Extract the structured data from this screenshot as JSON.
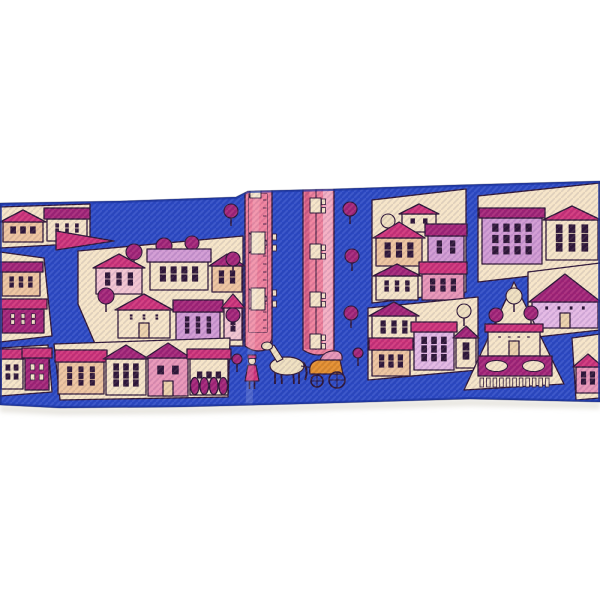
{
  "palette": {
    "white": "#ffffff",
    "blue": "#2c49c4",
    "blueDark": "#1d34a0",
    "outline": "#2e1536",
    "cream": "#f5e3c6",
    "creamDark": "#ecd0a9",
    "peach": "#edc39d",
    "palePink": "#f2c3cf",
    "pink": "#e793b5",
    "lilac": "#d098d2",
    "lilacLight": "#e2b6e2",
    "magenta": "#a32376",
    "rose": "#cd3178",
    "riverPink": "#ee7e9a",
    "riverLight": "#f3adc1",
    "riverDark": "#d75d82",
    "orange": "#e28c2b",
    "horse": "#efdfbe",
    "shadow": "#d9d5cc"
  },
  "scarf": {
    "band": {
      "top": [
        [
          0,
          203
        ],
        [
          120,
          201
        ],
        [
          236,
          197
        ],
        [
          248,
          191
        ],
        [
          332,
          189
        ],
        [
          455,
          185
        ],
        [
          600,
          181
        ]
      ],
      "bottom": [
        [
          0,
          405
        ],
        [
          60,
          408
        ],
        [
          180,
          407
        ],
        [
          300,
          404
        ],
        [
          470,
          399
        ],
        [
          600,
          402
        ]
      ]
    }
  },
  "scene": {
    "blocks": [
      {
        "name": "city-block-top-left",
        "ground": {
          "points": [
            [
              0,
              207
            ],
            [
              90,
              204
            ],
            [
              90,
              243
            ],
            [
              0,
              248
            ]
          ],
          "fill": "cream"
        },
        "items": [
          {
            "type": "house",
            "x": 3,
            "y": 242,
            "w": 40,
            "wallH": 20,
            "roofH": 12,
            "wall": "peach",
            "roof": "rose",
            "style": "gable",
            "win": [
              1,
              3
            ]
          },
          {
            "type": "house",
            "x": 47,
            "y": 241,
            "w": 40,
            "wallH": 22,
            "roofH": 11,
            "wall": "cream",
            "roof": "magenta",
            "style": "flat",
            "win": [
              2,
              3
            ]
          }
        ]
      },
      {
        "name": "street-spire",
        "items": [
          {
            "type": "spire",
            "pts": [
              [
                56,
                231
              ],
              [
                114,
                241
              ],
              [
                56,
                250
              ]
            ],
            "fill": "rose"
          }
        ]
      },
      {
        "name": "city-block-left-main",
        "ground": {
          "points": [
            [
              78,
              251
            ],
            [
              243,
              236
            ],
            [
              243,
              346
            ],
            [
              96,
              346
            ],
            [
              78,
              304
            ]
          ],
          "fill": "cream"
        },
        "items": [
          {
            "type": "tree",
            "x": 134,
            "y": 268,
            "r": 8
          },
          {
            "type": "tree",
            "x": 164,
            "y": 262,
            "r": 8
          },
          {
            "type": "tree",
            "x": 192,
            "y": 258,
            "r": 7
          },
          {
            "type": "house",
            "x": 96,
            "y": 294,
            "w": 46,
            "wallH": 26,
            "roofH": 14,
            "wall": "palePink",
            "roof": "rose",
            "style": "gable",
            "win": [
              2,
              3
            ]
          },
          {
            "type": "house",
            "x": 150,
            "y": 290,
            "w": 58,
            "wallH": 28,
            "roofH": 13,
            "wall": "cream",
            "roof": "lilac",
            "style": "flat",
            "win": [
              2,
              4
            ]
          },
          {
            "type": "house",
            "x": 212,
            "y": 292,
            "w": 30,
            "wallH": 26,
            "roofH": 12,
            "wall": "peach",
            "roof": "magenta",
            "style": "gable",
            "win": [
              2,
              2
            ]
          },
          {
            "type": "tree",
            "x": 106,
            "y": 312,
            "r": 8
          },
          {
            "type": "house",
            "x": 118,
            "y": 338,
            "w": 52,
            "wallH": 28,
            "roofH": 16,
            "wall": "cream",
            "roof": "rose",
            "style": "gable",
            "win": [
              2,
              3
            ],
            "door": true
          },
          {
            "type": "house",
            "x": 176,
            "y": 342,
            "w": 44,
            "wallH": 30,
            "roofH": 12,
            "wall": "lilac",
            "roof": "magenta",
            "style": "flat",
            "win": [
              3,
              3
            ]
          },
          {
            "type": "house",
            "x": 224,
            "y": 340,
            "w": 18,
            "wallH": 32,
            "roofH": 14,
            "wall": "palePink",
            "roof": "rose",
            "style": "gable",
            "win": [
              3,
              1
            ]
          }
        ]
      },
      {
        "name": "city-block-left-edge",
        "ground": {
          "points": [
            [
              0,
              252
            ],
            [
              44,
              258
            ],
            [
              52,
              336
            ],
            [
              0,
              342
            ]
          ],
          "fill": "cream"
        },
        "items": [
          {
            "type": "house",
            "x": 2,
            "y": 296,
            "w": 38,
            "wallH": 24,
            "roofH": 10,
            "wall": "peach",
            "roof": "magenta",
            "style": "flat",
            "win": [
              2,
              3
            ]
          },
          {
            "type": "house",
            "x": 2,
            "y": 333,
            "w": 42,
            "wallH": 24,
            "roofH": 10,
            "wall": "magenta",
            "roof": "rose",
            "style": "flat",
            "win": [
              2,
              3
            ],
            "winFill": "cream"
          }
        ]
      },
      {
        "name": "city-block-left-corner",
        "ground": {
          "points": [
            [
              0,
              348
            ],
            [
              48,
              345
            ],
            [
              52,
              392
            ],
            [
              0,
              396
            ]
          ],
          "fill": "cream"
        },
        "items": [
          {
            "type": "house",
            "x": 1,
            "y": 389,
            "w": 22,
            "wallH": 30,
            "roofH": 10,
            "wall": "cream",
            "roof": "rose",
            "style": "flat",
            "win": [
              2,
              2
            ]
          },
          {
            "type": "house",
            "x": 25,
            "y": 390,
            "w": 24,
            "wallH": 32,
            "roofH": 10,
            "wall": "magenta",
            "roof": "rose",
            "style": "flat",
            "win": [
              2,
              2
            ],
            "winFill": "cream"
          }
        ]
      },
      {
        "name": "city-block-bottom-row",
        "ground": {
          "points": [
            [
              54,
              344
            ],
            [
              230,
              338
            ],
            [
              228,
              397
            ],
            [
              60,
              400
            ]
          ],
          "fill": "cream"
        },
        "items": [
          {
            "type": "house",
            "x": 58,
            "y": 394,
            "w": 46,
            "wallH": 32,
            "roofH": 12,
            "wall": "peach",
            "roof": "rose",
            "style": "flat",
            "win": [
              3,
              3
            ]
          },
          {
            "type": "house",
            "x": 106,
            "y": 395,
            "w": 40,
            "wallH": 36,
            "roofH": 14,
            "wall": "cream",
            "roof": "magenta",
            "style": "gable",
            "win": [
              3,
              3
            ]
          },
          {
            "type": "house",
            "x": 148,
            "y": 396,
            "w": 40,
            "wallH": 38,
            "roofH": 15,
            "wall": "pink",
            "roof": "magenta",
            "style": "gable",
            "win": [
              1,
              2
            ],
            "door": true
          },
          {
            "type": "house",
            "x": 190,
            "y": 395,
            "w": 38,
            "wallH": 36,
            "roofH": 10,
            "wall": "cream",
            "roof": "rose",
            "style": "flat",
            "win": [
              1,
              3
            ],
            "cypress": 4
          }
        ]
      },
      {
        "name": "riverside-trees",
        "items": [
          {
            "type": "tree",
            "x": 231,
            "y": 226,
            "r": 7
          },
          {
            "type": "tree",
            "x": 233,
            "y": 274,
            "r": 7
          },
          {
            "type": "tree",
            "x": 233,
            "y": 330,
            "r": 7
          },
          {
            "type": "tree",
            "x": 350,
            "y": 224,
            "r": 7
          },
          {
            "type": "tree",
            "x": 352,
            "y": 271,
            "r": 7
          },
          {
            "type": "tree",
            "x": 351,
            "y": 328,
            "r": 7
          },
          {
            "type": "tree",
            "x": 237,
            "y": 372,
            "r": 5
          },
          {
            "type": "tree",
            "x": 358,
            "y": 366,
            "r": 5
          }
        ]
      },
      {
        "name": "city-block-right-top",
        "ground": {
          "points": [
            [
              372,
              200
            ],
            [
              466,
              189
            ],
            [
              466,
              292
            ],
            [
              372,
              303
            ]
          ],
          "fill": "cream"
        },
        "items": [
          {
            "type": "tree",
            "x": 388,
            "y": 236,
            "r": 7,
            "fill": "horse"
          },
          {
            "type": "house",
            "x": 402,
            "y": 232,
            "w": 34,
            "wallH": 18,
            "roofH": 10,
            "wall": "cream",
            "roof": "rose",
            "style": "gable",
            "win": [
              1,
              2
            ]
          },
          {
            "type": "house",
            "x": 376,
            "y": 266,
            "w": 46,
            "wallH": 28,
            "roofH": 16,
            "wall": "peach",
            "roof": "rose",
            "style": "gable",
            "win": [
              2,
              3
            ]
          },
          {
            "type": "house",
            "x": 428,
            "y": 262,
            "w": 36,
            "wallH": 26,
            "roofH": 12,
            "wall": "lilac",
            "roof": "magenta",
            "style": "flat",
            "win": [
              2,
              2
            ]
          },
          {
            "type": "house",
            "x": 376,
            "y": 300,
            "w": 42,
            "wallH": 24,
            "roofH": 12,
            "wall": "cream",
            "roof": "magenta",
            "style": "gable",
            "win": [
              2,
              3
            ]
          },
          {
            "type": "house",
            "x": 422,
            "y": 300,
            "w": 42,
            "wallH": 26,
            "roofH": 12,
            "wall": "pink",
            "roof": "rose",
            "style": "flat",
            "win": [
              2,
              3
            ]
          }
        ]
      },
      {
        "name": "city-block-top-right-corner",
        "ground": {
          "points": [
            [
              478,
              196
            ],
            [
              600,
              183
            ],
            [
              600,
              268
            ],
            [
              478,
              282
            ]
          ],
          "fill": "cream"
        },
        "items": [
          {
            "type": "house",
            "x": 482,
            "y": 264,
            "w": 60,
            "wallH": 46,
            "roofH": 10,
            "wall": "lilac",
            "roof": "magenta",
            "style": "flat",
            "win": [
              3,
              4
            ]
          },
          {
            "type": "house",
            "x": 546,
            "y": 260,
            "w": 52,
            "wallH": 40,
            "roofH": 14,
            "wall": "cream",
            "roof": "rose",
            "style": "gable",
            "win": [
              3,
              3
            ]
          }
        ]
      },
      {
        "name": "city-block-big-roof",
        "ground": {
          "points": [
            [
              528,
              272
            ],
            [
              600,
              263
            ],
            [
              600,
              330
            ],
            [
              528,
              338
            ]
          ],
          "fill": "cream"
        },
        "items": [
          {
            "type": "house",
            "x": 532,
            "y": 328,
            "w": 66,
            "wallH": 26,
            "roofH": 28,
            "wall": "lilacLight",
            "roof": "magenta",
            "style": "gable",
            "win": [
              1,
              4
            ],
            "door": true
          }
        ]
      },
      {
        "name": "city-block-right-mid",
        "ground": {
          "points": [
            [
              368,
              308
            ],
            [
              478,
              297
            ],
            [
              478,
              370
            ],
            [
              368,
              380
            ]
          ],
          "fill": "cream"
        },
        "items": [
          {
            "type": "tree",
            "x": 464,
            "y": 326,
            "r": 7,
            "fill": "horse"
          },
          {
            "type": "house",
            "x": 372,
            "y": 342,
            "w": 44,
            "wallH": 26,
            "roofH": 14,
            "wall": "cream",
            "roof": "magenta",
            "style": "gable",
            "win": [
              2,
              3
            ]
          },
          {
            "type": "house",
            "x": 414,
            "y": 370,
            "w": 40,
            "wallH": 38,
            "roofH": 10,
            "wall": "lilacLight",
            "roof": "rose",
            "style": "flat",
            "win": [
              3,
              3
            ]
          },
          {
            "type": "house",
            "x": 456,
            "y": 368,
            "w": 20,
            "wallH": 30,
            "roofH": 12,
            "wall": "cream",
            "roof": "magenta",
            "style": "gable",
            "win": [
              2,
              1
            ]
          },
          {
            "type": "house",
            "x": 372,
            "y": 376,
            "w": 38,
            "wallH": 26,
            "roofH": 12,
            "wall": "peach",
            "roof": "rose",
            "style": "flat",
            "win": [
              2,
              3
            ]
          }
        ]
      },
      {
        "name": "city-block-triangle-garden",
        "ground": {
          "points": [
            [
              514,
              282
            ],
            [
              564,
              384
            ],
            [
              464,
              390
            ]
          ],
          "fill": "cream"
        },
        "items": [
          {
            "type": "tree",
            "x": 514,
            "y": 312,
            "r": 8,
            "fill": "horse"
          },
          {
            "type": "tree",
            "x": 496,
            "y": 330,
            "r": 7
          },
          {
            "type": "tree",
            "x": 531,
            "y": 328,
            "r": 7
          },
          {
            "type": "house",
            "x": 488,
            "y": 356,
            "w": 52,
            "wallH": 24,
            "roofH": 8,
            "wall": "cream",
            "roof": "rose",
            "style": "flat",
            "win": [
              1,
              4
            ],
            "door": true
          },
          {
            "type": "garden",
            "x": 478,
            "y": 356,
            "w": 74,
            "h": 20,
            "fill": "magenta",
            "ovals": 2
          },
          {
            "type": "stripes",
            "x": 480,
            "y": 378,
            "w": 72,
            "h": 9,
            "n": 11
          }
        ]
      },
      {
        "name": "city-block-bottom-right-corner",
        "ground": {
          "points": [
            [
              572,
              338
            ],
            [
              600,
              334
            ],
            [
              600,
              398
            ],
            [
              576,
              400
            ]
          ],
          "fill": "cream"
        },
        "items": [
          {
            "type": "house",
            "x": 576,
            "y": 393,
            "w": 24,
            "wallH": 26,
            "roofH": 13,
            "wall": "pink",
            "roof": "rose",
            "style": "gable",
            "win": [
              2,
              2
            ]
          }
        ]
      }
    ],
    "river": {
      "bands": [
        {
          "x": 245,
          "w": 27,
          "top": 186,
          "bottom": 346,
          "style": "arch",
          "piers": [
            243,
            299
          ],
          "arcs": [
            215,
            271,
            327
          ]
        },
        {
          "x": 303,
          "w": 31,
          "top": 184,
          "bottom": 350,
          "style": "pier",
          "piers": [
            206,
            252,
            300,
            342
          ]
        }
      ]
    },
    "carriage": {
      "person": {
        "x": 252,
        "y": 389
      },
      "horse": {
        "cx": 287,
        "cy": 366
      },
      "cart": {
        "x": 310,
        "y": 374
      },
      "wheels": [
        [
          317,
          381,
          6
        ],
        [
          337,
          380,
          8
        ]
      ]
    }
  }
}
